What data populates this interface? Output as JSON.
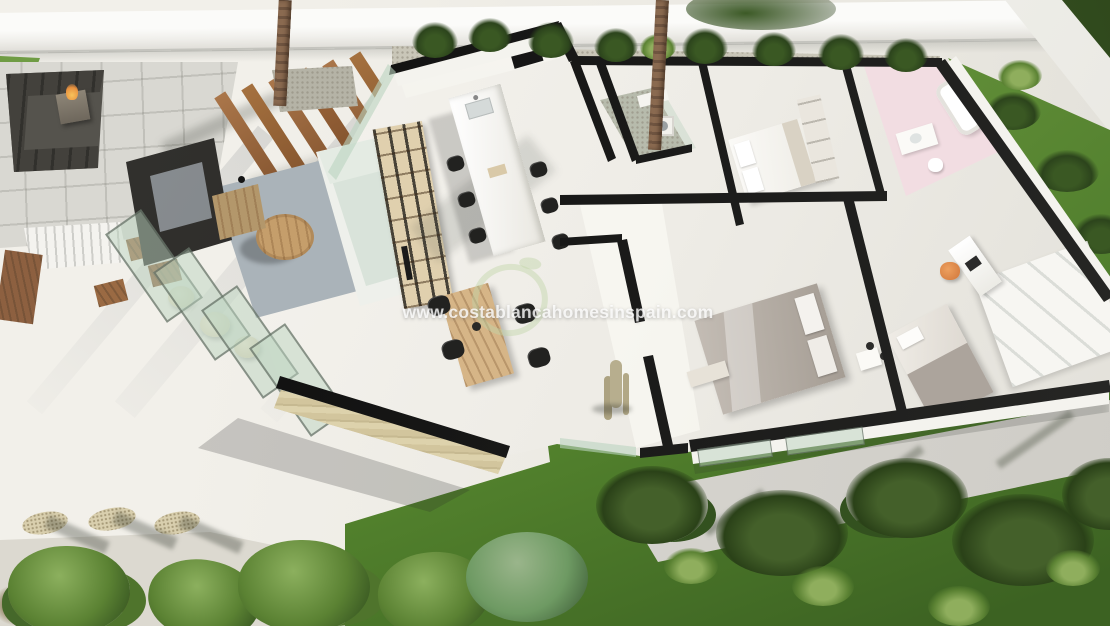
{
  "watermark": {
    "text": "www.costablancahomesinspain.com",
    "logo": "leaf-swirl-logo"
  },
  "scene": {
    "type": "3d-floorplan-render",
    "view": "aerial-isometric-cutaway-villa"
  },
  "palette": {
    "terrace": "#edebe5",
    "house_floor": "#f0eee9",
    "wall_cap_black": "#141414",
    "perimeter_wall_white": "#f7f6f2",
    "lawn_green": "#5a8c36",
    "lawn_dark": "#3f6625",
    "foliage_dark": "#2c441c",
    "bush_green": "#5b8233",
    "gravel": "#c9c6b8",
    "pavers_gray": "#d9d8d2",
    "sunken_sofa_charcoal": "#3b3a36",
    "fire_flame_orange": "#e8913f",
    "pergola_wood": "#9c6a3e",
    "furniture_wood": "#c59e6b",
    "rug_gray": "#aab3b9",
    "sofa_mint": "#dde6dd",
    "glass_mint": "#cfe0cf",
    "stone_wall_beige": "#d6caa4",
    "pink_bathroom": "#f2dde2",
    "duvet_gray": "#b3aba3",
    "desk_chair_orange": "#df8a4f",
    "path_gray": "#d8d6d1"
  }
}
